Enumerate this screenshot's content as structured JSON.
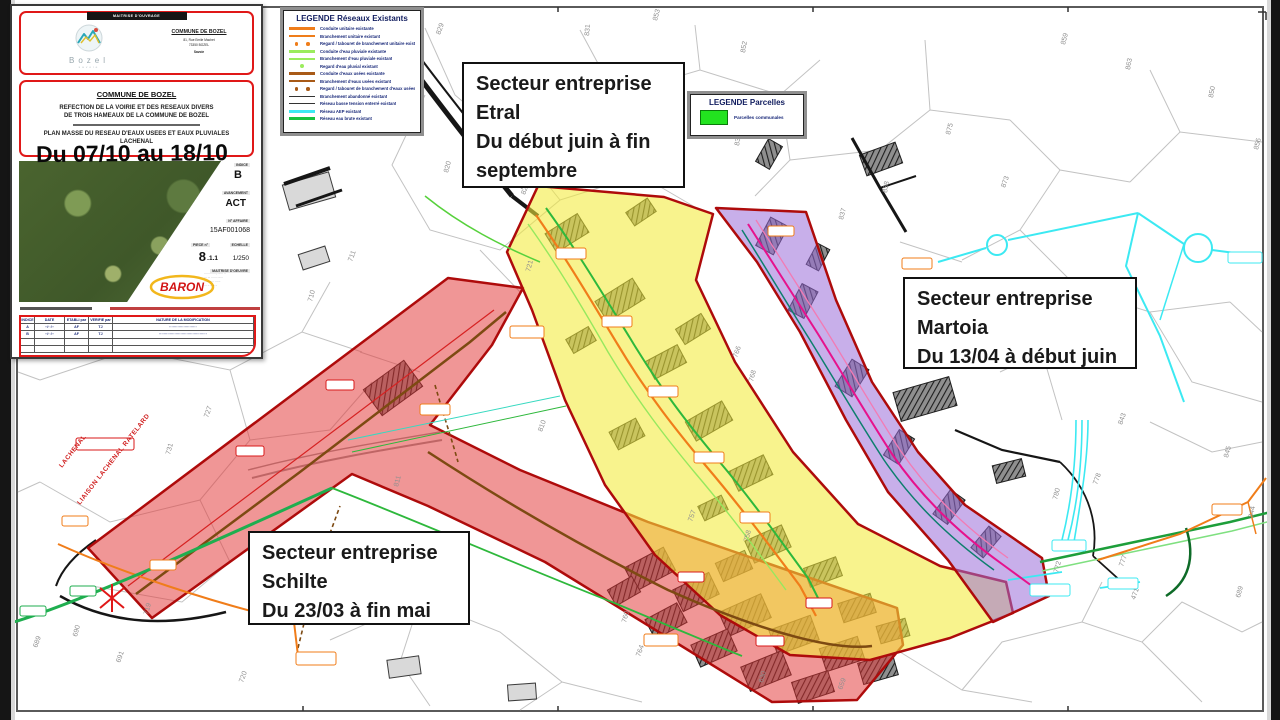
{
  "annotation_note": "Du 07/10 au 18/10",
  "title_block": {
    "owner_header": "MAITRISE D'OUVRAGE",
    "logo": {
      "name": "Bozel",
      "sub": "savoie"
    },
    "owner": {
      "name": "COMMUNE DE BOZEL",
      "lines": [
        "81, Rue Emile Machet",
        "73350 BOZEL",
        "Savoie"
      ]
    },
    "commune_title": "COMMUNE DE BOZEL",
    "project_lines": [
      "REFECTION DE LA VOIRIE ET DES RESEAUX DIVERS",
      "DE TROIS HAMEAUX DE LA COMMUNE DE BOZEL"
    ],
    "plan_lines": [
      "PLAN MASSE DU RESEAU D'EAUX USEES ET EAUX PLUVIALES",
      "LACHENAL"
    ],
    "fields": {
      "indice_label": "INDICE",
      "indice": "B",
      "phase_label": "AVANCEMENT",
      "phase": "ACT",
      "affaire_label": "N° AFFAIRE",
      "affaire": "15AF001068",
      "piece_label": "PIECE n°",
      "piece_major": "8",
      "piece_minor": ".1.1",
      "echelle_label": "ECHELLE",
      "echelle": "1/250"
    },
    "moe_header": "MAITRISE D'OEUVRE",
    "moe_name": "BARON",
    "revision_table": {
      "headers": [
        "INDICE",
        "DATE",
        "ETABLI par",
        "VERIFIE par",
        "NATURE DE LA MODIFICATION"
      ],
      "rows": [
        [
          "A",
          "··/··/··",
          "AF",
          "TJ",
          "·······················"
        ],
        [
          "B",
          "··/··/··",
          "AF",
          "TJ",
          "········································"
        ],
        [
          "",
          "",
          "",
          "",
          ""
        ],
        [
          "",
          "",
          "",
          "",
          ""
        ]
      ]
    }
  },
  "legend_networks": {
    "title": "LEGENDE Réseaux Existants",
    "rows": [
      {
        "label": "Conduite unitaire existante",
        "color": "#ef7d1a",
        "style": "thick"
      },
      {
        "label": "Branchement unitaire existant",
        "color": "#ef7d1a",
        "style": "line"
      },
      {
        "label": "Regard / tabouret de branchement unitaire existant",
        "color": "#ef7d1a",
        "style": "dots"
      },
      {
        "label": "Conduite d'eau pluviale existante",
        "color": "#9bec5d",
        "style": "thick"
      },
      {
        "label": "Branchement d'eau pluviale existant",
        "color": "#9bec5d",
        "style": "line"
      },
      {
        "label": "Regard d'eau pluvial existant",
        "color": "#9bec5d",
        "style": "dot"
      },
      {
        "label": "Conduite d'eaux usées existante",
        "color": "#a85a17",
        "style": "thick"
      },
      {
        "label": "Branchement d'eaux usées existant",
        "color": "#a85a17",
        "style": "line"
      },
      {
        "label": "Regard / tabouret de branchement d'eaux usées existant",
        "color": "#a85a17",
        "style": "dots"
      },
      {
        "label": "Branchement abandonné existant",
        "color": "#333333",
        "style": "thin"
      },
      {
        "label": "Réseau basse tension enterré existant",
        "color": "#333333",
        "style": "thin"
      },
      {
        "label": "Réseau AEP existant",
        "color": "#3ce9f2",
        "style": "thick"
      },
      {
        "label": "Réseau eau brute existant",
        "color": "#17c23f",
        "style": "thick"
      }
    ]
  },
  "legend_parcels": {
    "title": "LEGENDE Parcelles",
    "item": "Parcelles communales",
    "swatch_color": "#22e31f"
  },
  "sectors": {
    "etral": {
      "lines": [
        "Secteur entreprise",
        "Etral",
        "Du début juin à fin septembre"
      ]
    },
    "martoia": {
      "lines": [
        "Secteur entreprise",
        "Martoia",
        "Du 13/04 à début juin"
      ]
    },
    "schilte": {
      "lines": [
        "Secteur entreprise",
        "Schilte",
        "Du 23/03 à fin mai"
      ]
    }
  },
  "zones": {
    "schilte_color": "#e23535",
    "etral_color": "#f3ea3a",
    "martoia_color": "#9a6ed8",
    "border_color": "#ae0b0b"
  },
  "map": {
    "parcel_numbers": [
      {
        "n": "853",
        "x": 657,
        "y": 21,
        "rot": -75
      },
      {
        "n": "852",
        "x": 745,
        "y": 53,
        "rot": -80
      },
      {
        "n": "829",
        "x": 440,
        "y": 35,
        "rot": -70
      },
      {
        "n": "831",
        "x": 589,
        "y": 36,
        "rot": -85
      },
      {
        "n": "830",
        "x": 739,
        "y": 146,
        "rot": -80
      },
      {
        "n": "820",
        "x": 448,
        "y": 173,
        "rot": -75
      },
      {
        "n": "824",
        "x": 525,
        "y": 195,
        "rot": -70
      },
      {
        "n": "838",
        "x": 887,
        "y": 193,
        "rot": -80
      },
      {
        "n": "837",
        "x": 843,
        "y": 220,
        "rot": -75
      },
      {
        "n": "859",
        "x": 1065,
        "y": 45,
        "rot": -75
      },
      {
        "n": "863",
        "x": 1130,
        "y": 70,
        "rot": -80
      },
      {
        "n": "875",
        "x": 950,
        "y": 135,
        "rot": -75
      },
      {
        "n": "873",
        "x": 1005,
        "y": 188,
        "rot": -70
      },
      {
        "n": "850",
        "x": 1213,
        "y": 98,
        "rot": -80
      },
      {
        "n": "856",
        "x": 1258,
        "y": 150,
        "rot": -75
      },
      {
        "n": "843",
        "x": 1122,
        "y": 425,
        "rot": -70
      },
      {
        "n": "845",
        "x": 1228,
        "y": 458,
        "rot": -75
      },
      {
        "n": "778",
        "x": 1097,
        "y": 485,
        "rot": -70
      },
      {
        "n": "780",
        "x": 1057,
        "y": 500,
        "rot": -75
      },
      {
        "n": "844",
        "x": 1253,
        "y": 518,
        "rot": -80
      },
      {
        "n": "777",
        "x": 1123,
        "y": 567,
        "rot": -70
      },
      {
        "n": "772",
        "x": 1058,
        "y": 573,
        "rot": -75
      },
      {
        "n": "471",
        "x": 1135,
        "y": 600,
        "rot": -70
      },
      {
        "n": "689",
        "x": 1240,
        "y": 598,
        "rot": -75
      },
      {
        "n": "689",
        "x": 37,
        "y": 648,
        "rot": -70
      },
      {
        "n": "690",
        "x": 77,
        "y": 637,
        "rot": -75
      },
      {
        "n": "691",
        "x": 120,
        "y": 663,
        "rot": -70
      },
      {
        "n": "719",
        "x": 148,
        "y": 615,
        "rot": -75
      },
      {
        "n": "720",
        "x": 243,
        "y": 683,
        "rot": -70
      },
      {
        "n": "760",
        "x": 626,
        "y": 623,
        "rot": -75
      },
      {
        "n": "764",
        "x": 640,
        "y": 657,
        "rot": -70
      },
      {
        "n": "630",
        "x": 763,
        "y": 683,
        "rot": -75
      },
      {
        "n": "659",
        "x": 842,
        "y": 690,
        "rot": -70
      },
      {
        "n": "721",
        "x": 530,
        "y": 272,
        "rot": -75
      },
      {
        "n": "711",
        "x": 352,
        "y": 262,
        "rot": -70
      },
      {
        "n": "710",
        "x": 312,
        "y": 302,
        "rot": -75
      },
      {
        "n": "757",
        "x": 692,
        "y": 522,
        "rot": -70
      },
      {
        "n": "758",
        "x": 748,
        "y": 542,
        "rot": -75
      },
      {
        "n": "766",
        "x": 737,
        "y": 358,
        "rot": -70
      },
      {
        "n": "768",
        "x": 753,
        "y": 382,
        "rot": -75
      },
      {
        "n": "810",
        "x": 542,
        "y": 432,
        "rot": -70
      },
      {
        "n": "811",
        "x": 398,
        "y": 487,
        "rot": -75
      },
      {
        "n": "727",
        "x": 208,
        "y": 418,
        "rot": -70
      },
      {
        "n": "731",
        "x": 170,
        "y": 455,
        "rot": -75
      }
    ],
    "road_labels": [
      {
        "text": "LACHENAL",
        "x": 62,
        "y": 468,
        "rot": -52
      },
      {
        "text": "LIAISON LACHENAL RATELARD",
        "x": 80,
        "y": 505,
        "rot": -52
      }
    ]
  }
}
